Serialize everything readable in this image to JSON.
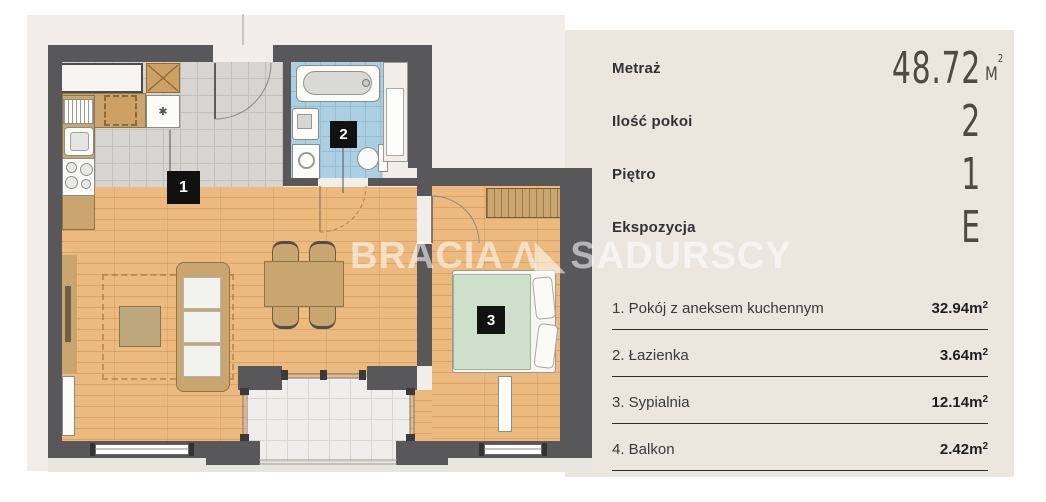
{
  "panel": {
    "specs": [
      {
        "label": "Metraż",
        "value": "48.72",
        "unit_base": "M",
        "unit_sup": "2"
      },
      {
        "label": "Ilość pokoi",
        "value": "2",
        "unit_base": "",
        "unit_sup": ""
      },
      {
        "label": "Piętro",
        "value": "1",
        "unit_base": "",
        "unit_sup": ""
      },
      {
        "label": "Ekspozycja",
        "value": "E",
        "unit_base": "",
        "unit_sup": ""
      }
    ],
    "rooms": [
      {
        "name": "1. Pokój z aneksem kuchennym",
        "area": "32.94",
        "unit_base": "m",
        "unit_sup": "2"
      },
      {
        "name": "2. Łazienka",
        "area": "3.64",
        "unit_base": "m",
        "unit_sup": "2"
      },
      {
        "name": "3. Sypialnia",
        "area": "12.14",
        "unit_base": "m",
        "unit_sup": "2"
      },
      {
        "name": "4. Balkon",
        "area": "2.42",
        "unit_base": "m",
        "unit_sup": "2"
      }
    ]
  },
  "watermark": {
    "part1": "BRACIA",
    "logo_glyph": "Λ◣",
    "part2": "SADURSCY"
  },
  "plan": {
    "badges": {
      "living": "1",
      "bath": "2",
      "bedroom": "3"
    }
  },
  "colors": {
    "panel_bg": "#ebe7df",
    "plan_bg": "#f1eee9",
    "wall": "#58585b",
    "wood_floor": "#ecba7e",
    "kitchen_tile": "#d7d5d2",
    "bath_tile": "#abd0e4",
    "balcony_tile": "#efeeec",
    "furniture_tan": "#c9a66f",
    "badge_bg": "#111111",
    "text_dark": "#323232"
  }
}
